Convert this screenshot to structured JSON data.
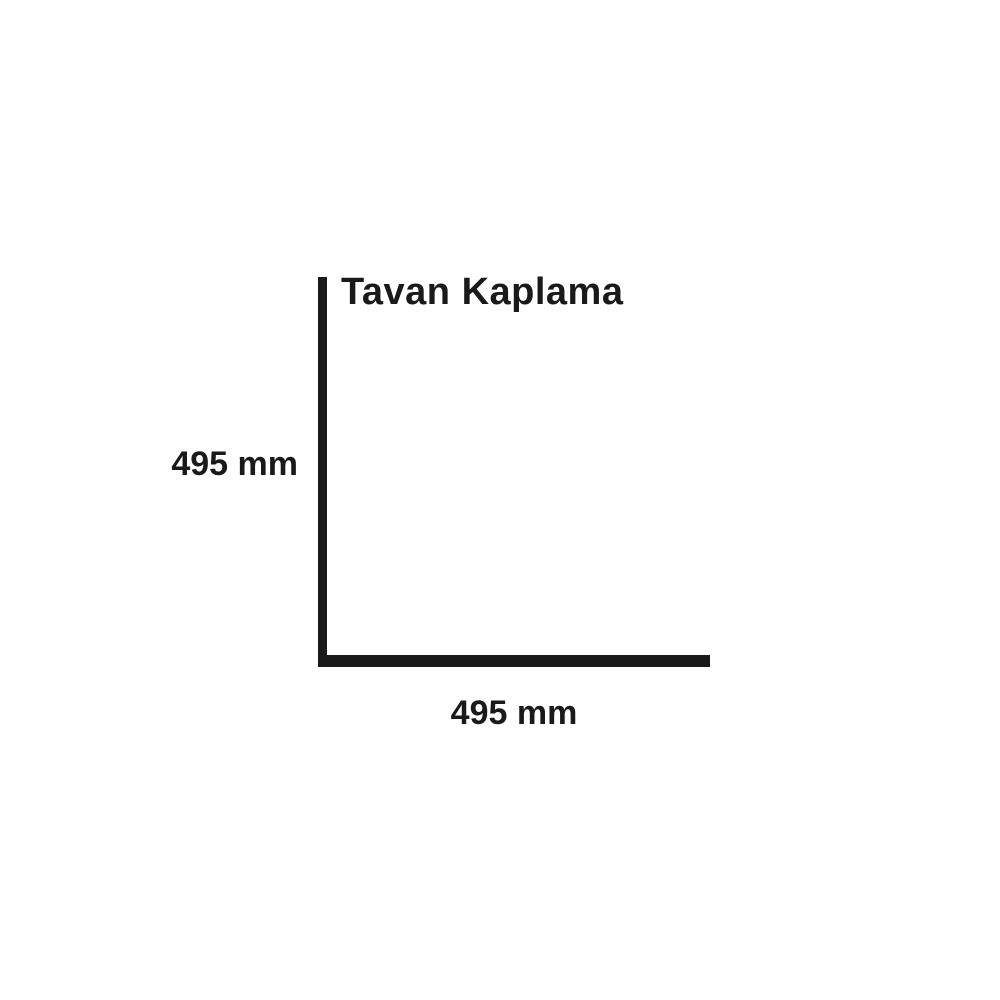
{
  "diagram": {
    "title": "Tavan Kaplama",
    "height_label": "495 mm",
    "width_label": "495 mm",
    "height_value_mm": 495,
    "width_value_mm": 495,
    "line_color": "#1a1a1a",
    "background_color": "#ffffff"
  }
}
